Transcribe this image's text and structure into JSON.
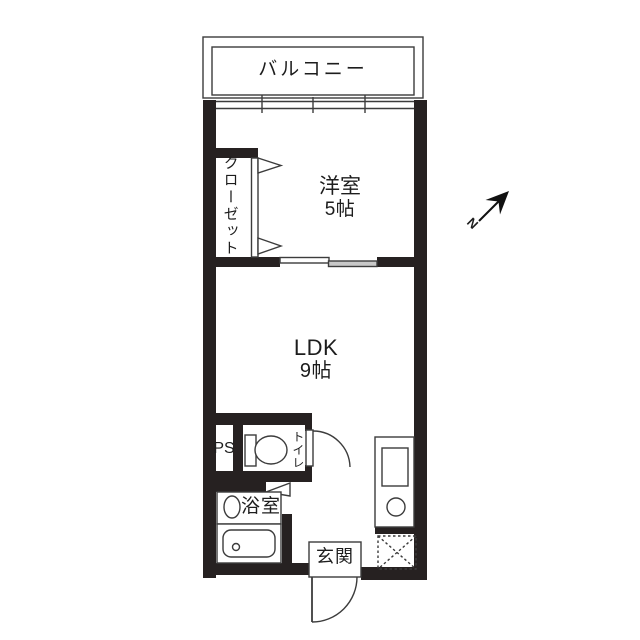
{
  "plan": {
    "type": "floor-plan",
    "balcony_label": "バルコニー",
    "western_room_label": "洋室",
    "western_room_size": "5帖",
    "closet_label": "クローゼット",
    "ldk_label": "LDK",
    "ldk_size": "9帖",
    "ps_label": "PS",
    "toilet_label": "トイレ",
    "bath_label": "浴室",
    "entrance_label": "玄関",
    "compass_label": "N"
  },
  "colors": {
    "background": "#ffffff",
    "wall": "#262121",
    "thin_line": "#3c3c3c",
    "sliding_door_panel": "#c8c8c8",
    "text": "#1d1d1d"
  }
}
